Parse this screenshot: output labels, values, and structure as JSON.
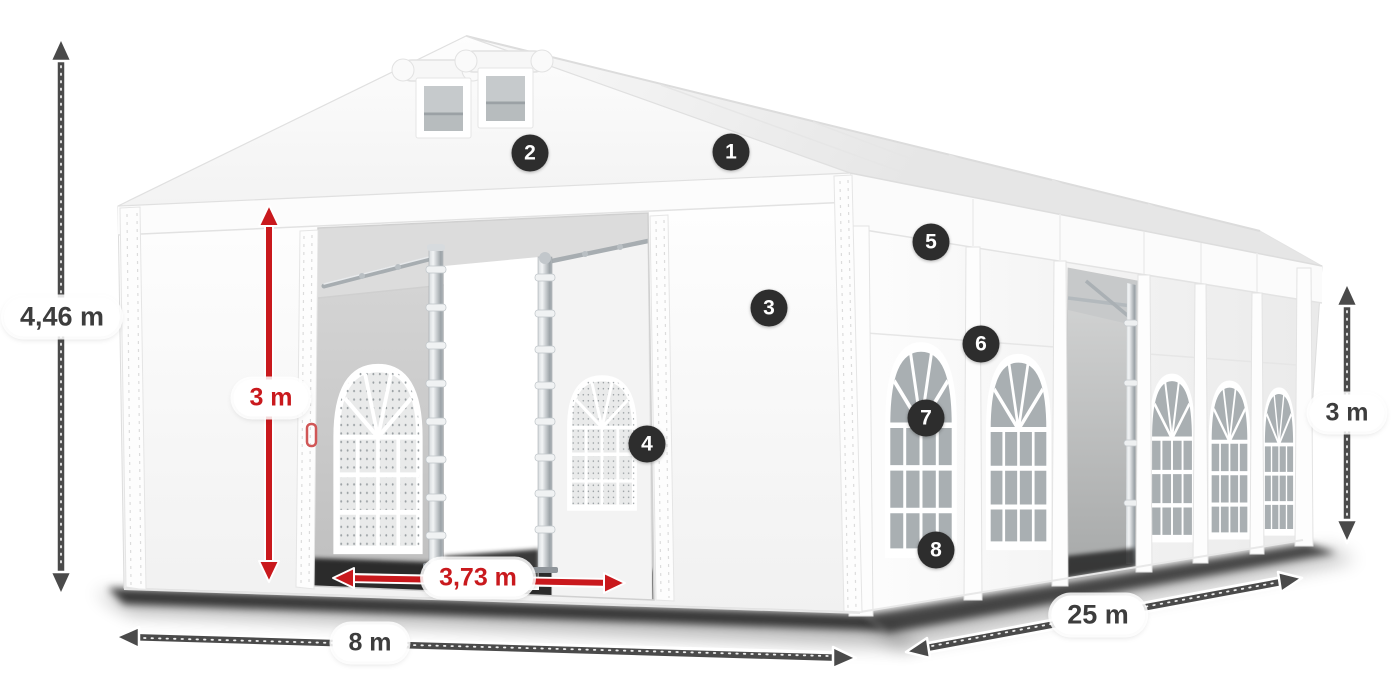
{
  "illustration": {
    "description": "White marquee tent in perspective with numbered feature markers and dimension arrows",
    "background": "#ffffff"
  },
  "colors": {
    "arrow_dark": "#4a4a4a",
    "arrow_red": "#c9191d",
    "badge_background": "#2d2d2d",
    "badge_text": "#ffffff",
    "label_background": "#ffffff",
    "label_text": "#3d3d3d"
  },
  "dimensions": {
    "total_height": {
      "label": "4,46 m",
      "color": "dark"
    },
    "entrance_height": {
      "label": "3 m",
      "color": "red"
    },
    "entrance_width": {
      "label": "3,73 m",
      "color": "red"
    },
    "front_width": {
      "label": "8 m",
      "color": "dark"
    },
    "side_length": {
      "label": "25 m",
      "color": "dark"
    },
    "wall_height": {
      "label": "3 m",
      "color": "dark"
    }
  },
  "markers": [
    {
      "number": "1"
    },
    {
      "number": "2"
    },
    {
      "number": "3"
    },
    {
      "number": "4"
    },
    {
      "number": "5"
    },
    {
      "number": "6"
    },
    {
      "number": "7"
    },
    {
      "number": "8"
    }
  ]
}
